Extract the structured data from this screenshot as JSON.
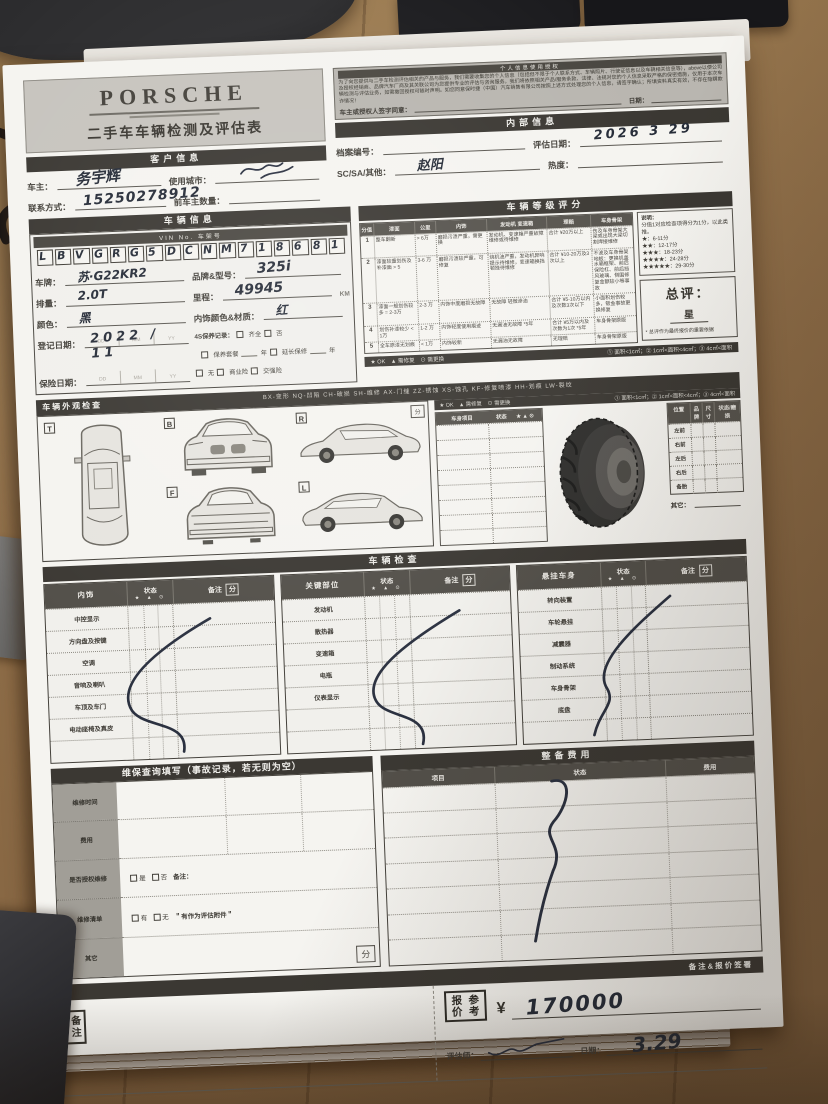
{
  "header": {
    "brand": "PORSCHE",
    "title": "二手车车辆检测及评估表"
  },
  "disclaimer": {
    "heading": "个人信息使用授权",
    "body": "为了向您提供与二手车检测评估相关的产品与服务，我们需要收集您的个人信息（包括但不限于个人联系方式、车辆照片、行驶证信息以及车辆相关信息等），above以便公司及授权经销商、品牌汽车厂商及其关联公司为您提供专业的评估与咨询服务。我们将依照相关产品/服务条款、法律、法规对您的个人信息采取严格的保密措施，仅用于本次车辆检测与评估业务，如需撤回授权可随时声明。如您同意保时捷（中国）汽车销售有限公司按照上述方式处理您的个人信息，请签字确认；所填资料真实有效，不存在隐瞒欺诈情况！",
    "sign_label": "车主或授权人签字同意：",
    "date_label": "日期："
  },
  "customer": {
    "section_title": "客户信息",
    "owner_label": "车主：",
    "owner_value": "务宇辉",
    "city_label": "使用城市：",
    "phone_label": "联系方式：",
    "phone_value": "15250278912",
    "prev_owners_label": "前车主数量："
  },
  "internal": {
    "section_title": "内部信息",
    "file_no_label": "档案编号：",
    "eval_date_label": "评估日期：",
    "eval_date_value": "2026 3 29",
    "sc_label": "SC/SA/其他：",
    "sc_value": "赵阳",
    "heat_label": "热度："
  },
  "vehicle": {
    "section_title": "车辆信息",
    "vin_label": "VIN No. 车架号",
    "vin_chars": [
      "L",
      "B",
      "V",
      "G",
      "R",
      "G",
      "5",
      "D",
      "C",
      "N",
      "M",
      "7",
      "1",
      "8",
      "6",
      "8",
      "1"
    ],
    "plate_label": "车牌：",
    "plate_value": "苏·G22KR2",
    "model_label": "品牌&型号：",
    "model_value": "325i",
    "disp_label": "排量：",
    "disp_value": "2.0T",
    "mileage_label": "里程：",
    "mileage_value": "49945",
    "mileage_unit": "KM",
    "color_label": "颜色：",
    "color_value": "黑",
    "interior_label": "内饰颜色&材质：",
    "interior_value": "红",
    "reg_label": "登记日期：",
    "reg_value": "2022 / 11",
    "slot_dd": "DD",
    "slot_mm": "MM",
    "slot_yy": "YY",
    "service_label": "4S保养记录：",
    "service_opt1": "齐全",
    "service_opt2": "否",
    "service_opt3": "保养套餐",
    "service_unit3": "年",
    "service_opt4": "延长保修",
    "service_unit4": "年",
    "insurance_label": "保险日期：",
    "ins_opt1": "无",
    "ins_opt2": "商业险",
    "ins_opt3": "交强险"
  },
  "grade": {
    "section_title": "车辆等级评分",
    "headers": {
      "h0": "分值",
      "h1": "漆面",
      "h2": "公里",
      "h3": "内饰",
      "h4": "发动机 变速箱",
      "h5": "理赔",
      "h6": "车身骨架"
    },
    "rows": [
      {
        "c0": "1",
        "c1": "整车翻新",
        "c2": "> 6万",
        "c3": "磨损污渍严重，需更换",
        "c4": "发动机、变速箱严重故障维修或待维修",
        "c5": "合计 ¥20万以上",
        "c6": "伤及车身骨架大梁或出现大梁切割焊接维修"
      },
      {
        "c0": "2",
        "c1": "漆面较重划伤及补漆面 > 5",
        "c2": "3-6 万",
        "c3": "磨损污渍较严重，可修复",
        "c4": "烧机油严重，发动机异响提示待维修，变速箱换挡顿挫待维修",
        "c5": "合计 ¥10-20万及3次以上",
        "c6": "不波及车身骨架地板：更换机盖水箱框架、前后保险杠、前后挡风玻璃、侧围修复金额较小等事故"
      },
      {
        "c0": "3",
        "c1": "漆面一般划伤较多 = 2-3万",
        "c2": "2-3 万",
        "c3": "内饰中度磨损无故障",
        "c4": "无故障 轻微渗油",
        "c5": "合计 ¥5-10万以内及次数3次以下",
        "c6": "小面积划伤较多，钣金事故更换修复"
      },
      {
        "c0": "4",
        "c1": "划伤补漆较少 < 1万",
        "c2": "1-2 万",
        "c3": "内饰轻度使用痕迹",
        "c4": "无漏油无故障 *5年",
        "c5": "合计 ¥5万以内及次数为1次 *5年",
        "c6": "车身骨架原版"
      },
      {
        "c0": "5",
        "c1": "全车原漆无划痕",
        "c2": "< 1万",
        "c3": "内饰较新",
        "c4": "无漏油无故障",
        "c5": "无理赔",
        "c6": "车身骨架原版"
      }
    ],
    "note_title": "说明：",
    "note_line": "分值1对应检查项得分为1分，以此类推。",
    "stars": [
      "★：6-11分",
      "★★：12-17分",
      "★★★：18-23分",
      "★★★★：24-28分",
      "★★★★★：29-30分"
    ],
    "overall_label": "总评：",
    "overall_unit": "星",
    "overall_note": "* 总评作为最终报价的重要依据",
    "legend_left": "★ OK　▲ 需修复　⊙ 需更换",
    "legend_right": "① 面积<1c㎡；② 1c㎡<面积<4c㎡；③ 4c㎡<面积"
  },
  "exterior": {
    "section_title": "车辆外观检查",
    "legend": "BX-变形  NQ-凹陷  CH-破损  SH-维修  AX-门缝  ZZ-锈蚀  XS-蚀孔  KF-修复喷漆  HH-划痕  LW-裂纹",
    "views": [
      "T",
      "B",
      "R",
      "F",
      "L"
    ],
    "score_box": "分"
  },
  "body_check": {
    "item_header": "车身项目",
    "state_header": "状态",
    "icons": "★ ▲ ⊙"
  },
  "tires": {
    "headers": [
      "位置",
      "品牌",
      "尺寸",
      "状态/磨损"
    ],
    "positions": [
      "左前",
      "右前",
      "左后",
      "右后",
      "备胎"
    ],
    "other_label": "其它："
  },
  "inspection": {
    "section_title": "车辆检查",
    "state_header": "状态",
    "note_header": "备注",
    "score_label": "分",
    "icons": "★ ▲ ⊙",
    "tables": [
      {
        "title": "内饰",
        "rows": [
          "中控显示",
          "方向盘及按键",
          "空调",
          "音响及喇叭",
          "车顶及车门",
          "电动座椅及真皮"
        ]
      },
      {
        "title": "关键部位",
        "rows": [
          "发动机",
          "散热器",
          "变速箱",
          "电瓶",
          "仪表显示"
        ]
      },
      {
        "title": "悬挂车身",
        "rows": [
          "转向装置",
          "车轮悬挂",
          "减震器",
          "制动系统",
          "车身骨架",
          "底盘"
        ]
      }
    ]
  },
  "maintenance": {
    "section_title": "维保查询填写（事故记录，若无则为空）",
    "rows": [
      "维修时间",
      "费用",
      "是否授权维修",
      "维修清单",
      "其它"
    ],
    "auth_opt1": "是",
    "auth_opt2": "否",
    "auth_note": "备注：",
    "list_opt1": "有",
    "list_opt2": "无",
    "list_note": "＂有作为评估附件＂",
    "score_label": "分"
  },
  "prep": {
    "section_title": "整备费用",
    "headers": [
      "项目",
      "状态",
      "费用"
    ]
  },
  "footer": {
    "section_title": "备注&报价签署",
    "notes_label": "备注",
    "quote_col1": "报价",
    "quote_col2": "参考",
    "currency": "¥",
    "amount": "170000",
    "assessor_label": "评估师：",
    "date_label": "日期：",
    "date_value": "3.29"
  }
}
